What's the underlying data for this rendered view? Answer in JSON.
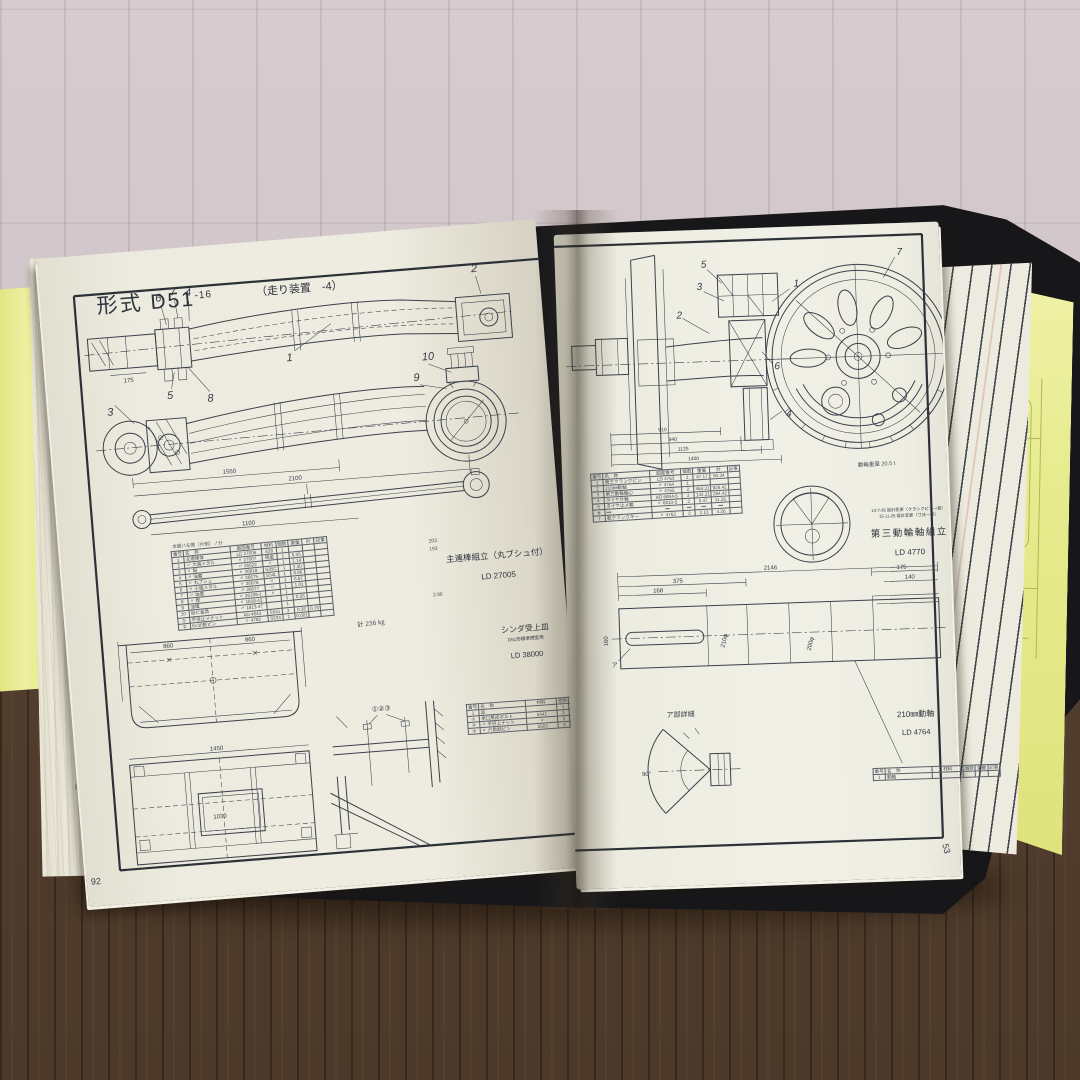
{
  "left_page": {
    "page_number": "92",
    "title": "形式 D51",
    "title_suffix": "-16",
    "subtitle": "（走り装置　-4）",
    "rod": {
      "callouts": [
        "6",
        "7",
        "4",
        "5",
        "8",
        "3",
        "1",
        "2",
        "10",
        "9"
      ],
      "dims": [
        "175",
        "1550",
        "2100",
        "1100"
      ]
    },
    "table_note": "本図ハ左側（片側）ノ分",
    "parts_table": {
      "headers": [
        "番号",
        "名　称",
        "図面番号",
        "材料",
        "個数",
        "重量",
        "計",
        "記事"
      ],
      "rows": [
        [
          "1",
          "主連棒体",
          "LD 27006",
          "S28",
          "1",
          "",
          "",
          ""
        ],
        [
          "2",
          "〃 大端メタル",
          "〃 27007",
          "砲金",
          "1",
          "6.35",
          "",
          ""
        ],
        [
          "3",
          "〃 鎹",
          "〃 26622",
          "〃",
          "1",
          "1.14",
          "",
          ""
        ],
        [
          "4",
          "〃 油蓋",
          "〃 26618",
          "S35C",
          "1",
          "2.30",
          "",
          ""
        ],
        [
          "5",
          "〃 丸ブシュ",
          "〃 26675",
          "S54L",
          "1",
          "6.86",
          "",
          ""
        ],
        [
          "6",
          "〃 小端メタル",
          "〃 26678",
          "〃",
          "1",
          "6.87",
          "",
          ""
        ],
        [
          "7",
          "〃 油壺",
          "〃 26677",
          "〃",
          "1",
          "1.01",
          "",
          ""
        ],
        [
          "8",
          "〃 楔",
          "〃 26199-1",
          "〃",
          "1",
          "",
          "",
          ""
        ],
        [
          "9",
          "油堰",
          "〃 1818-43",
          "",
          "1",
          "0.35",
          "",
          ""
        ],
        [
          "10",
          "結ビ金具",
          "〃 1813-47",
          "",
          "1",
          "",
          "",
          ""
        ],
        [
          "①",
          "平径止メナット",
          "AD 4643",
          "S541",
          "2",
          "0.35",
          "0.70",
          ""
        ],
        [
          "②",
          "6×30割ピン",
          "〃 4782",
          "S534",
          "1",
          "0.001",
          "",
          ""
        ]
      ],
      "side_notes": [
        "203",
        "193",
        "2.96"
      ],
      "total": "計 236 ㎏"
    },
    "rod_caption": {
      "line1": "主連棒組立（丸ブシュ付）",
      "line2": "LD 27005"
    },
    "cinder_caption": {
      "line1": "シンダ受上皿",
      "line2": "D51形標準煙室用",
      "line3": "LD 38000"
    },
    "pan": {
      "dims": [
        "860",
        "860",
        "1450",
        "1030"
      ],
      "callouts": "①②③"
    },
    "small_table": {
      "headers": [
        "番号",
        "名　称",
        "材料",
        "個数",
        "重量",
        "記事"
      ],
      "rows": [
        [
          "1",
          "皿",
          "",
          "1",
          "",
          "570"
        ],
        [
          "①",
          "承口黒皮ボルト",
          "5541",
          "3",
          "",
          "68747"
        ],
        [
          "②",
          "〃 平径上ナット",
          "〃",
          "3",
          "",
          "+324"
        ],
        [
          "③",
          "〃 六角割ピン",
          "5503",
          "3",
          "",
          "71.223"
        ]
      ]
    }
  },
  "right_page": {
    "page_number": "53",
    "wheel": {
      "callouts": [
        "5",
        "3",
        "2",
        "1",
        "7",
        "6",
        "4"
      ],
      "dims": [
        "910",
        "940",
        "1125",
        "1400"
      ]
    },
    "weight_note": "動輪重量 20.5 t",
    "parts_table": {
      "headers": [
        "番号",
        "名　称",
        "図面番号",
        "個数",
        "重量",
        "計",
        "記事"
      ],
      "rows": [
        [
          "1",
          "第三クランクピン",
          "LD 4763",
          "2",
          "47.17",
          "94.34",
          ""
        ],
        [
          "2",
          "210㎜動軸",
          "〃 4764",
          "1",
          "",
          "",
          ""
        ],
        [
          "3",
          "第三動輪輪心",
          "〃 4765",
          "2",
          "464.21",
          "928.42",
          ""
        ],
        [
          "4",
          "タイヤ外輪",
          "AD 6804-5",
          "2",
          "142.21",
          "284.42",
          ""
        ],
        [
          "5",
          "タイヤ止メ輪",
          "〃 6810-5",
          "2",
          "5.47",
          "11.26",
          ""
        ],
        [
          "6",
          "―",
          "―",
          "―",
          "―",
          "―",
          ""
        ],
        [
          "7",
          "轂クランクキー",
          "〃 4762",
          "2",
          "2.13",
          "4.26",
          ""
        ]
      ]
    },
    "rev_notes": [
      "13-7-26 設計変更（クランクピン一部）",
      "15-11-25 設計変更（寸法一部）"
    ],
    "assembly_caption": {
      "line1": "第三動輪軸組立",
      "line2": "LD 4770"
    },
    "axle": {
      "dims": [
        "2146",
        "375",
        "168",
        "160",
        "210φ",
        "200φ",
        "175",
        "140"
      ],
      "ref": "ア",
      "detail_label": "ア部詳細",
      "angle": "90°"
    },
    "axle_caption": {
      "line1": "210㎜動軸",
      "line2": "LD 4764"
    },
    "small_table": {
      "headers": [
        "番号",
        "名　称",
        "材料",
        "個数",
        "重量",
        "記事"
      ],
      "rows": [
        [
          "1",
          "動軸",
          "",
          "",
          "",
          ""
        ]
      ]
    }
  },
  "edge_marks": [
    "3",
    "2",
    "6"
  ],
  "tab": {
    "label": "図",
    "number": "51/30"
  }
}
